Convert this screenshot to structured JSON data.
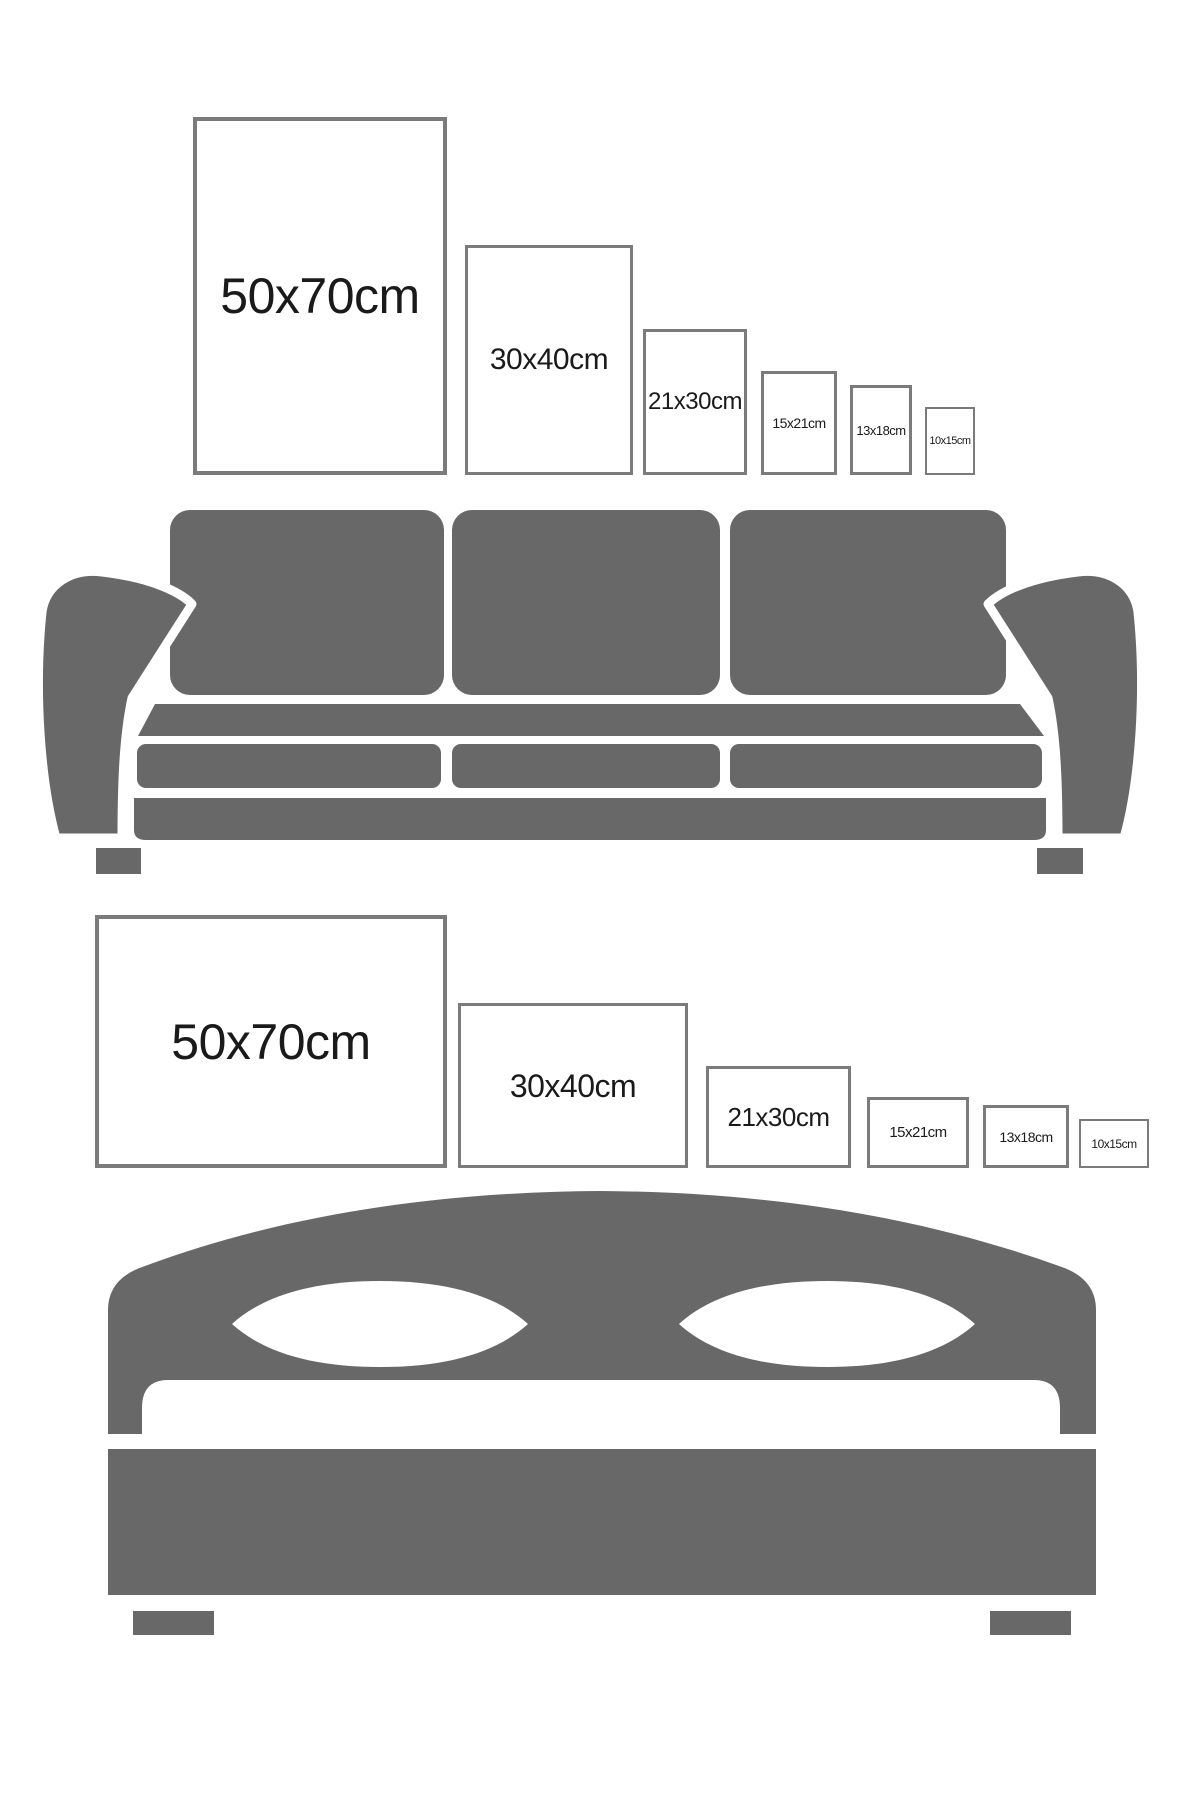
{
  "page": {
    "background": "#ffffff"
  },
  "colors": {
    "furniture": "#686868",
    "frame_border": "#7b7b7b",
    "label_text": "#1a1a1a"
  },
  "portrait_row": {
    "frames": [
      {
        "label": "50x70cm",
        "orientation": "portrait"
      },
      {
        "label": "30x40cm",
        "orientation": "portrait"
      },
      {
        "label": "21x30cm",
        "orientation": "portrait"
      },
      {
        "label": "15x21cm",
        "orientation": "portrait"
      },
      {
        "label": "13x18cm",
        "orientation": "portrait"
      },
      {
        "label": "10x15cm",
        "orientation": "portrait"
      }
    ]
  },
  "landscape_row": {
    "frames": [
      {
        "label": "50x70cm",
        "orientation": "landscape"
      },
      {
        "label": "30x40cm",
        "orientation": "landscape"
      },
      {
        "label": "21x30cm",
        "orientation": "landscape"
      },
      {
        "label": "15x21cm",
        "orientation": "landscape"
      },
      {
        "label": "13x18cm",
        "orientation": "landscape"
      },
      {
        "label": "10x15cm",
        "orientation": "landscape"
      }
    ]
  },
  "illustrations": {
    "sofa": "sofa-icon",
    "bed": "bed-icon"
  }
}
